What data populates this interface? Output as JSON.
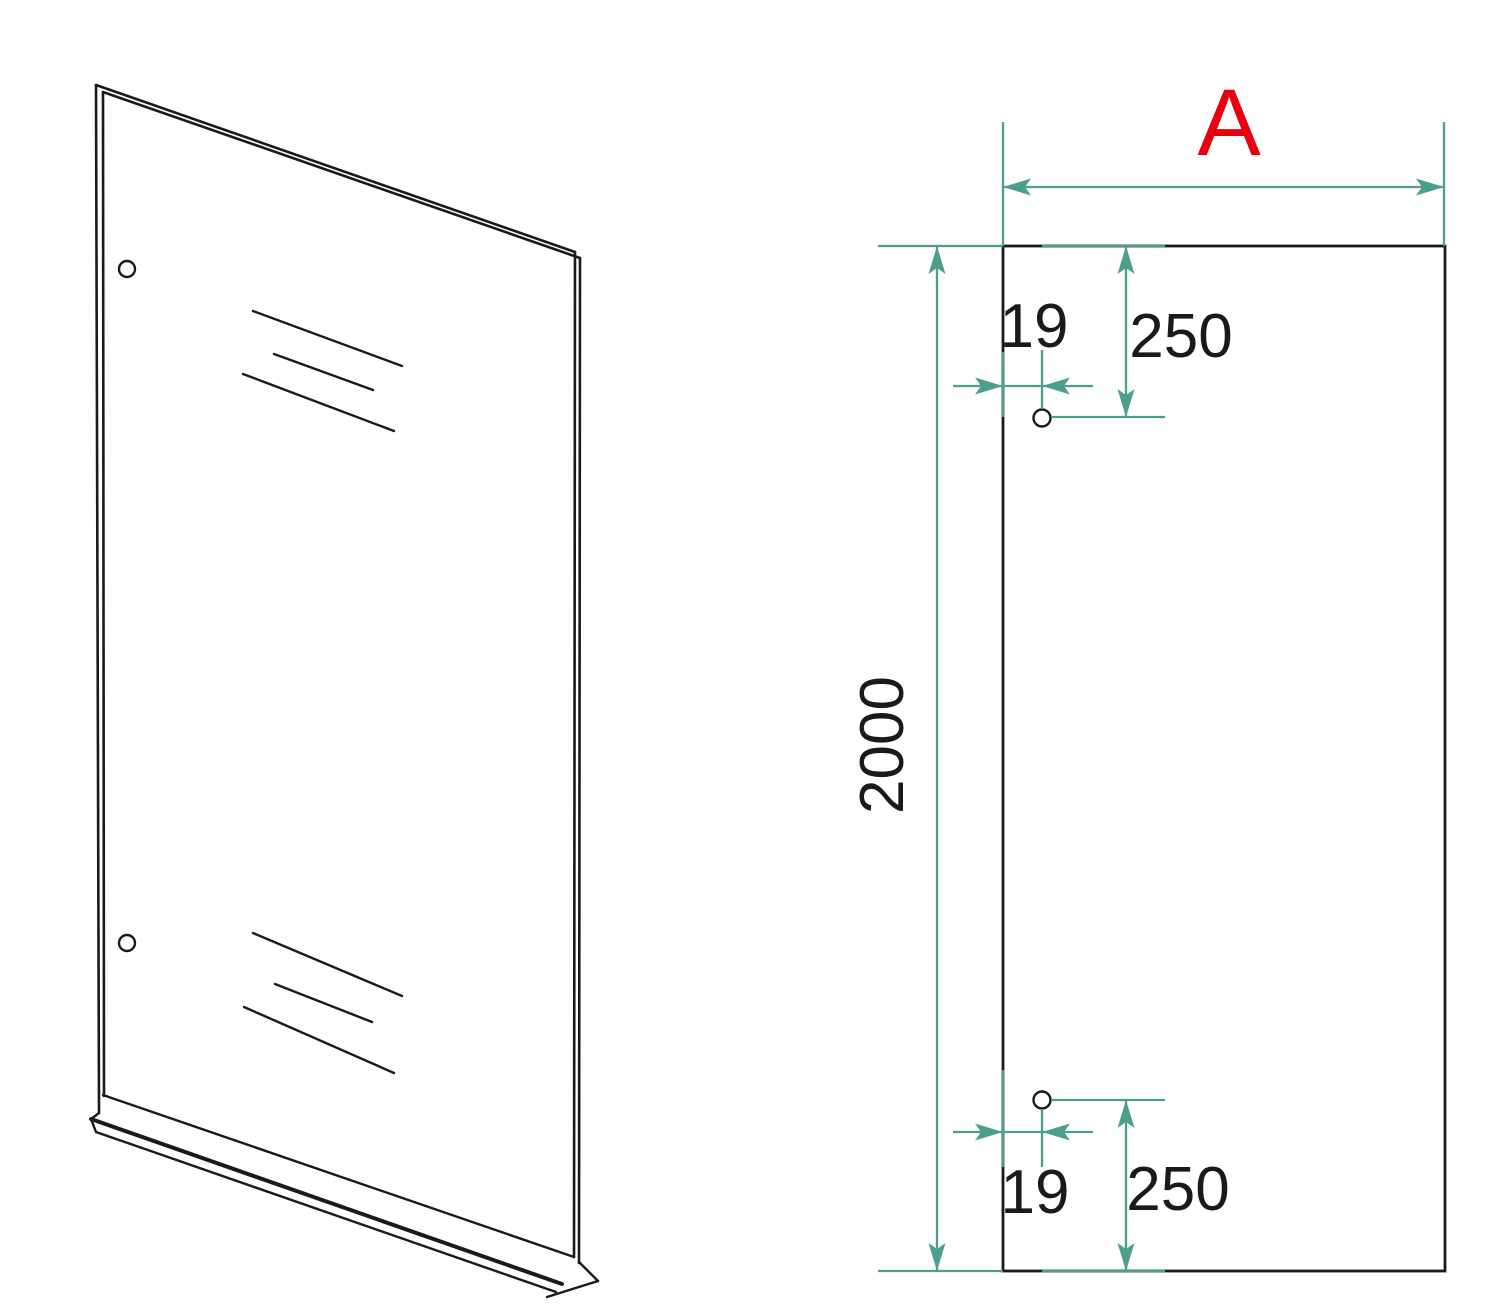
{
  "drawing": {
    "labels": {
      "width": "A",
      "height": "2000",
      "top_hole_edge_offset": "19",
      "top_hole_vertical_offset": "250",
      "bottom_hole_edge_offset": "19",
      "bottom_hole_vertical_offset": "250"
    },
    "colors": {
      "dimension": "#4D9F8D",
      "outline": "#1A1A1A",
      "dimension_text": "#1A1A1A",
      "width_label": "#E8000F",
      "background": "#FFFFFF"
    }
  }
}
